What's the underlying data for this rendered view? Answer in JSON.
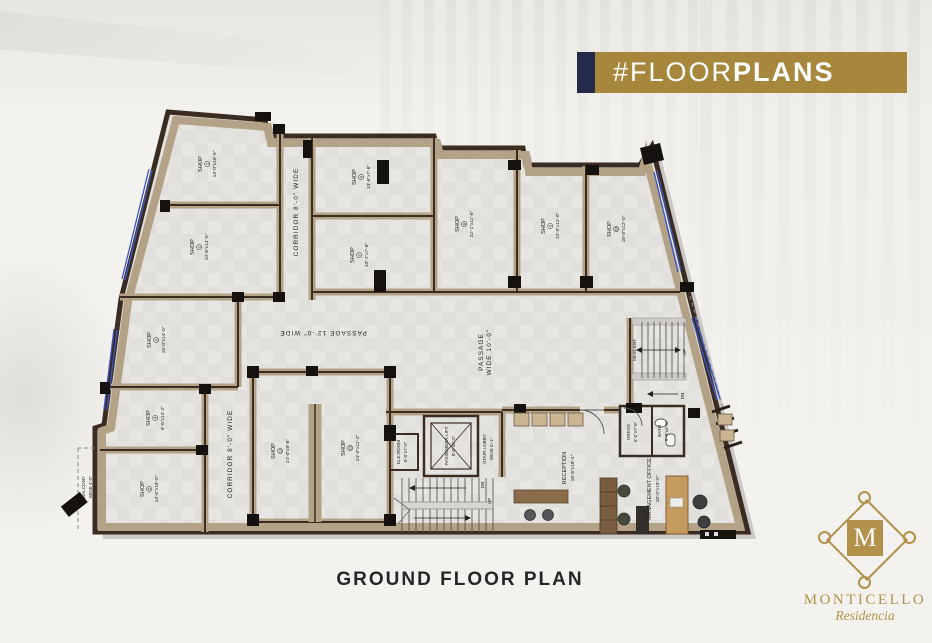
{
  "banner": {
    "text_regular": "#FLOOR",
    "text_bold": "PLANS",
    "bg_color": "#a6873c",
    "accent_color": "#232a4a"
  },
  "plan_title": "GROUND FLOOR PLAN",
  "logo": {
    "monogram": "M",
    "name": "MONTICELLO",
    "script": "Residencia",
    "color": "#b2914a"
  },
  "shops": [
    {
      "name": "SHOP",
      "num": "1",
      "dims": "13'-0\"x16'-9\""
    },
    {
      "name": "SHOP",
      "num": "2",
      "dims": "10'-6\"x14'-6\""
    },
    {
      "name": "SHOP",
      "num": "3",
      "dims": "15'-0\"x14'-0\""
    },
    {
      "name": "SHOP",
      "num": "4",
      "dims": "9'-6\"x14'-2\""
    },
    {
      "name": "SHOP",
      "num": "5",
      "dims": "13'-6\"x18'-0\""
    },
    {
      "name": "SHOP",
      "num": "6",
      "dims": "13'-6\"x7'-6\""
    },
    {
      "name": "SHOP",
      "num": "7",
      "dims": "10'-1\"x7'-6\""
    },
    {
      "name": "SHOP",
      "num": "8",
      "dims": "22'-1\"x11'-6\""
    },
    {
      "name": "SHOP",
      "num": "9",
      "dims": "13'-0\"x11'-0\""
    },
    {
      "name": "SHOP",
      "num": "10",
      "dims": "18'-0\"x12'-0\""
    },
    {
      "name": "SHOP",
      "num": "11",
      "dims": "24'-0\"x8'-6\""
    },
    {
      "name": "SHOP",
      "num": "12",
      "dims": "24'-0\"x11'-2\""
    }
  ],
  "labels": {
    "corridor_top": "CORRIDOR 8'-0\" WIDE",
    "corridor_bottom": "CORRIDOR 8'-0\" WIDE",
    "passage_h": "PASSAGE 12'-0\" WIDE",
    "passage_v_line1": "PASSAGE",
    "passage_v_line2": "WIDE 10'-0\"",
    "main_ent": "MAIN ENT",
    "up": "UP",
    "dn": "DN",
    "stair_lobby_line1": "STAIR LOBBY",
    "stair_lobby_line2": "WIDE 5'-1\"",
    "lift_line1": "PASSENGER LIFT",
    "lift_line2": "8'-0\"x8'-0\"",
    "ele_line1": "ELE.ROOM",
    "ele_line2": "5'-0\"x7'-0\"",
    "reception_line1": "RECEPTION",
    "reception_line2": "18'-6\"x18'-4\"",
    "dress_line1": "DRESS",
    "dress_line2": "5'-0\"x7'-6\"",
    "bath_line1": "BATH",
    "bath_line2": "5'-0\"x4'-6\"",
    "office_line1": "MANAGEMENT OFFICE",
    "office_line2": "18'-0\"x18'-0\"",
    "balcony_line1": "BALCONY",
    "balcony_line2": "WIDE 4'-0\""
  },
  "colors": {
    "wall_dark": "#3b2c21",
    "wall_tan": "#b3a286",
    "floor": "#e8e6e2",
    "glazing_blue": "#3c55c4"
  }
}
